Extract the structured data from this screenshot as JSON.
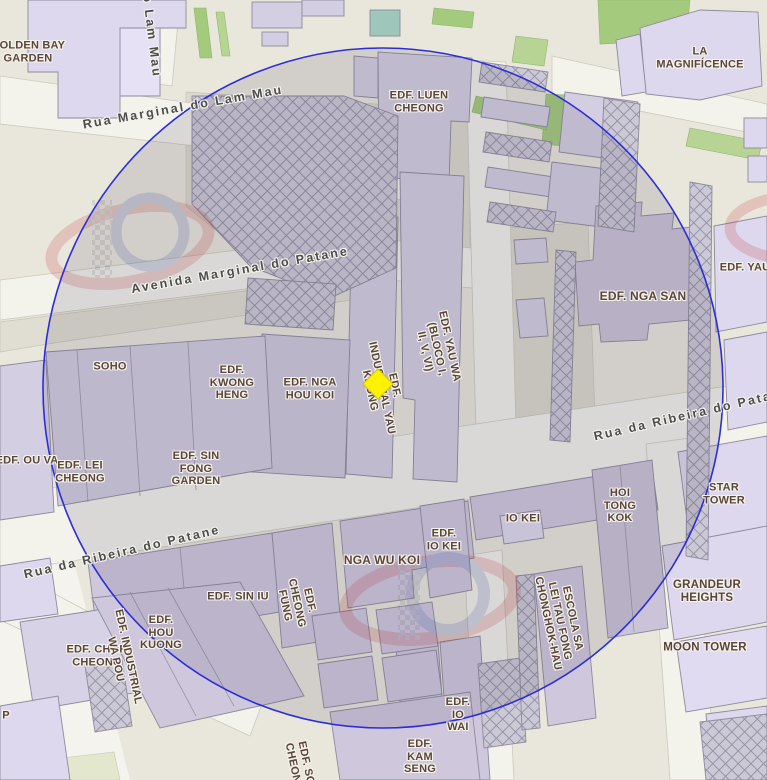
{
  "map": {
    "streets": [
      {
        "text": "Rua Marginal do Lam Mau",
        "x": 183,
        "y": 107,
        "rot": -10
      },
      {
        "text": "o Lam Mau",
        "x": 152,
        "y": 36,
        "rot": 83
      },
      {
        "text": "Avenida Marginal do Patane",
        "x": 240,
        "y": 270,
        "rot": -10
      },
      {
        "text": "Rua da Ribeira do Patane",
        "x": 692,
        "y": 414,
        "rot": -13
      },
      {
        "text": "Rua da Ribeira do Patane",
        "x": 122,
        "y": 552,
        "rot": -13
      }
    ],
    "buildings": [
      {
        "lines": [
          "GOLDEN BAY",
          "GARDEN"
        ],
        "x": 28,
        "y": 52
      },
      {
        "lines": [
          "EDF. LUEN",
          "CHEONG"
        ],
        "x": 419,
        "y": 102
      },
      {
        "lines": [
          "LA",
          "MAGNIFÍCENCE"
        ],
        "x": 700,
        "y": 58
      },
      {
        "lines": [
          "EDF. NGA SAN"
        ],
        "x": 643,
        "y": 297,
        "size": 12
      },
      {
        "lines": [
          "EDF. YAU"
        ],
        "x": 745,
        "y": 268
      },
      {
        "lines": [
          "SOHO"
        ],
        "x": 110,
        "y": 367
      },
      {
        "lines": [
          "EDF.",
          "KWONG",
          "HENG"
        ],
        "x": 232,
        "y": 383
      },
      {
        "lines": [
          "EDF. NGA",
          "HOU KOI"
        ],
        "x": 310,
        "y": 389
      },
      {
        "lines": [
          "EDF.",
          "INDUSTRIAL YAU",
          "KEONG"
        ],
        "x": 382,
        "y": 388,
        "rot": 78
      },
      {
        "lines": [
          "EDF. YAU WA",
          "(BLOCO I,",
          "II, V, VI)"
        ],
        "x": 437,
        "y": 349,
        "rot": 78
      },
      {
        "lines": [
          "EDF. OU VA"
        ],
        "x": 27,
        "y": 461
      },
      {
        "lines": [
          "EDF. LEI",
          "CHEONG"
        ],
        "x": 80,
        "y": 472
      },
      {
        "lines": [
          "EDF. SIN",
          "FONG",
          "GARDEN"
        ],
        "x": 196,
        "y": 469
      },
      {
        "lines": [
          "HOI",
          "TONG",
          "KOK"
        ],
        "x": 620,
        "y": 506
      },
      {
        "lines": [
          "STAR",
          "TOWER"
        ],
        "x": 724,
        "y": 494
      },
      {
        "lines": [
          "IO KEI"
        ],
        "x": 523,
        "y": 519
      },
      {
        "lines": [
          "EDF.",
          "IO KEI"
        ],
        "x": 444,
        "y": 540
      },
      {
        "lines": [
          "NGA WU KOI"
        ],
        "x": 382,
        "y": 561,
        "size": 12
      },
      {
        "lines": [
          "EDF. SIN IU"
        ],
        "x": 238,
        "y": 597
      },
      {
        "lines": [
          "EDF.",
          "CHEONG",
          "FUNG"
        ],
        "x": 297,
        "y": 603,
        "rot": 78
      },
      {
        "lines": [
          "ESCOLA SA",
          "LEI TAU FONG",
          "CHONGHOK-HAU"
        ],
        "x": 560,
        "y": 621,
        "rot": 78
      },
      {
        "lines": [
          "GRANDEUR",
          "HEIGHTS"
        ],
        "x": 707,
        "y": 592,
        "size": 11.5
      },
      {
        "lines": [
          "MOON TOWER"
        ],
        "x": 705,
        "y": 648,
        "size": 11.5
      },
      {
        "lines": [
          "EDF. CHOR",
          "CHEONG"
        ],
        "x": 97,
        "y": 656
      },
      {
        "lines": [
          "EDF.",
          "HOU",
          "KUONG"
        ],
        "x": 161,
        "y": 633
      },
      {
        "lines": [
          "EDF. INDUSTRIAL",
          "WA POU"
        ],
        "x": 122,
        "y": 658,
        "rot": 78
      },
      {
        "lines": [
          "P"
        ],
        "x": 6,
        "y": 716
      },
      {
        "lines": [
          "EDF.",
          "IO",
          "WAI"
        ],
        "x": 458,
        "y": 715
      },
      {
        "lines": [
          "EDF.",
          "KAM",
          "SENG"
        ],
        "x": 420,
        "y": 757
      },
      {
        "lines": [
          "EDF. SOI",
          "CHEONG"
        ],
        "x": 300,
        "y": 766,
        "rot": 78
      }
    ],
    "marker": {
      "shape": "diamond",
      "color": "#fff200",
      "x": 378,
      "y": 384
    },
    "circle": {
      "stroke": "#2d2dd6",
      "fill": "rgba(68,66,90,0.14)"
    },
    "colors": {
      "land": "#e9e7dc",
      "road": "#f3f2eb",
      "plaza": "#dbd9cc",
      "building": "#d4cee2",
      "building_pale": "#ded8ee",
      "building_dark": "#cbc4d8",
      "hatch": "#cbc8d6",
      "green": "#a4cb7d",
      "street_label": "#4c4c4c",
      "building_label": "#5a453a"
    }
  }
}
